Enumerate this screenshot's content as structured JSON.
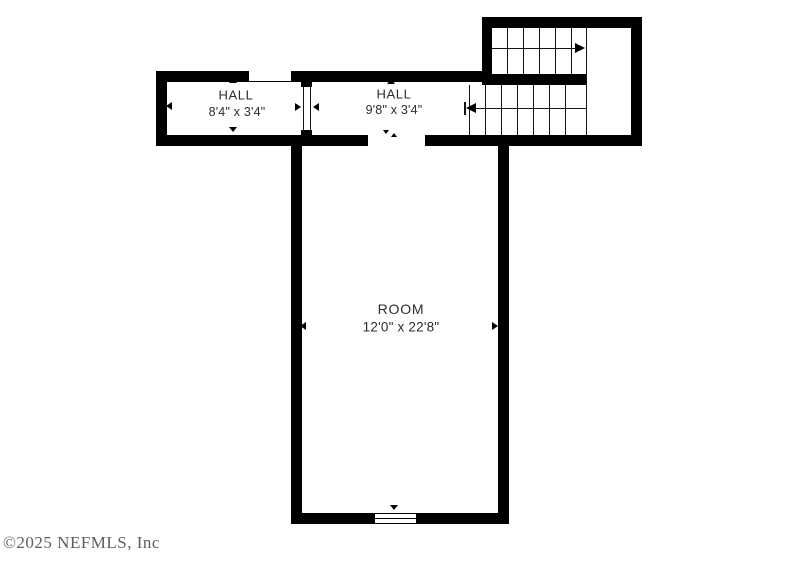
{
  "floor_plan": {
    "rooms": [
      {
        "name": "HALL",
        "dimensions": "8'4\" x 3'4\""
      },
      {
        "name": "HALL",
        "dimensions": "9'8\" x 3'4\""
      },
      {
        "name": "ROOM",
        "dimensions": "12'0\" x 22'8\""
      }
    ],
    "stairs": {
      "upper_flight_direction": "right",
      "lower_flight_direction": "left"
    },
    "watermark": "©2025 NEFMLS, Inc",
    "colors": {
      "wall": "#000000",
      "label_text": "#2d2d2d",
      "watermark_text": "#5e5e5e",
      "background": "#ffffff"
    }
  }
}
